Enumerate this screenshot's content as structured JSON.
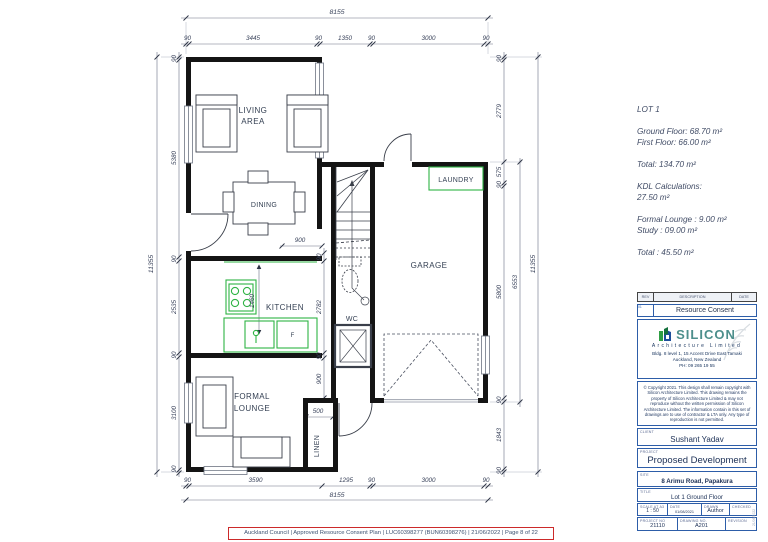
{
  "plan": {
    "rooms": {
      "living1": "LIVING",
      "living2": "AREA",
      "dining": "DINING",
      "kitchen": "KITCHEN",
      "formal1": "FORMAL",
      "formal2": "LOUNGE",
      "garage": "GARAGE",
      "wc": "WC",
      "laundry": "LAUNDRY",
      "linen": "LINEN",
      "fridge": "F"
    },
    "dims": {
      "top_overall": "8155",
      "top": [
        "90",
        "3445",
        "90",
        "1350",
        "90",
        "3000",
        "90"
      ],
      "bottom": [
        "90",
        "3590",
        "1295",
        "90",
        "3000",
        "90"
      ],
      "bottom_overall": "8155",
      "left_overall": "11355",
      "left": [
        "90",
        "5380",
        "90",
        "2535",
        "90",
        "3100",
        "90"
      ],
      "right": [
        "90",
        "2779",
        "575",
        "90",
        "5800",
        "90",
        "1843",
        "90"
      ],
      "right_mid": "6553",
      "right_overall": "11355",
      "hall": [
        "90",
        "2782",
        "90",
        "900"
      ],
      "dining_opening": "900",
      "bench": "1460",
      "linen_width": "500"
    }
  },
  "info": {
    "lot": "LOT 1",
    "ground": "Ground Floor: 68.70 m²",
    "first": "First Floor: 66.00 m²",
    "total": "Total: 134.70 m²",
    "kdl_title": "KDL Calculations:",
    "kdl_value": "27.50 m²",
    "formal_lounge": "Formal Lounge : 9.00 m²",
    "study": "Study : 09.00 m²",
    "grand_total": "Total : 45.50 m²"
  },
  "titleblock": {
    "rev_header": {
      "rev": "REV",
      "description": "DESCRIPTION",
      "date": "DATE"
    },
    "rev_row": {
      "code": "01",
      "description": "Resource Consent"
    },
    "logo": {
      "brand": "SILICON",
      "sub": "Architecture Limited",
      "addr1": "Bldg. 8 level 1, 15 Accent Drive East Tamaki",
      "addr2": "Auckland, New Zealand",
      "addr3": "PH: 09 265 19 55"
    },
    "copyright": "© Copyright 2021. This design shall remain copyright with Silicon Architecture Limited. This drawing remains the property of Silicon Architecture Limited & may not reproduce without the written permission of Silicon Architecture Limited. The information contain in this set of drawings are to use of contractor & LTA only. Any type of reproduction is not permitted.",
    "client_label": "CLIENT",
    "client": "Sushant Yadav",
    "project_label": "PROJECT",
    "project": "Proposed Development",
    "site_label": "SITE",
    "site": "8 Arimu Road, Papakura",
    "title_label": "TITLE",
    "title": "Lot 1 Ground Floor",
    "scale_label": "SCALE AT A3",
    "scale": "1 : 50",
    "date_label": "DATE",
    "date": "01/08/2021",
    "drawn_label": "DRAWN",
    "drawn": "Author",
    "checked_label": "CHECKED",
    "checked": "",
    "projno_label": "PROJECT NO",
    "projno": "21110",
    "dwgno_label": "DRAWING NO.",
    "dwgno": "A201",
    "revision_label": "REVISION",
    "revision": "",
    "stamp": "21/06/2022"
  },
  "footer": {
    "text": "Auckland Council  |  Approved Resource Consent Plan  |  LUC60398277 (BUN60398276)  |  21/06/2022  |  Page 8 of 22"
  }
}
